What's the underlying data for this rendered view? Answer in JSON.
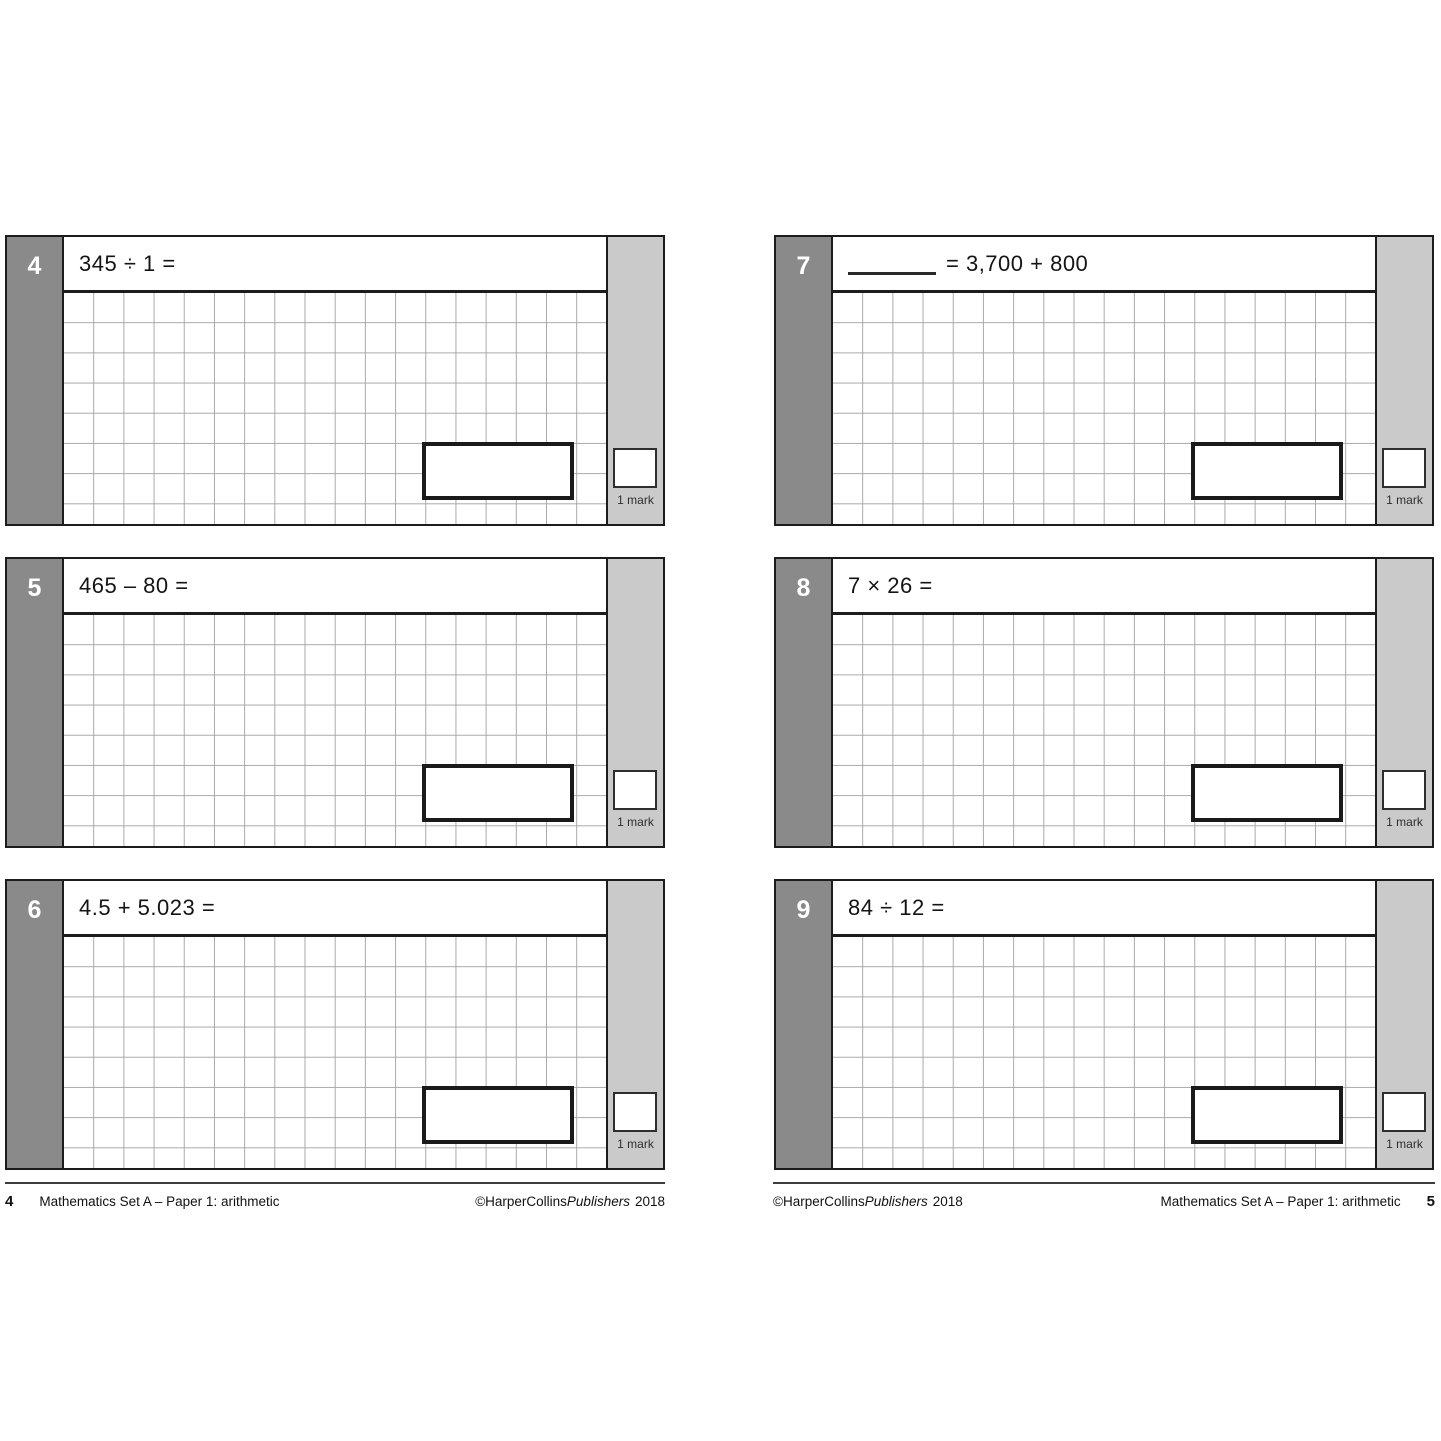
{
  "document": {
    "footer_title": "Mathematics Set A – Paper 1: arithmetic",
    "copyright_prefix": "©HarperCollins",
    "copyright_publisher": "Publishers",
    "copyright_year": "2018"
  },
  "pages": {
    "left_page_number": "4",
    "right_page_number": "5"
  },
  "questions": [
    {
      "number": "4",
      "text": "345 ÷ 1 =",
      "mark": "1 mark"
    },
    {
      "number": "5",
      "text": "465 – 80 =",
      "mark": "1 mark"
    },
    {
      "number": "6",
      "text": "4.5 + 5.023 =",
      "mark": "1 mark"
    },
    {
      "number": "7",
      "text": "= 3,700 + 800",
      "mark": "1 mark",
      "answer_blank_before_text": true
    },
    {
      "number": "8",
      "text": "7 × 26 =",
      "mark": "1 mark"
    },
    {
      "number": "9",
      "text": "84 ÷ 12 =",
      "mark": "1 mark"
    }
  ],
  "colors": {
    "badge_gray": "#8a8a8a",
    "mark_column_gray": "#cacaca",
    "grid_line_gray": "#a9a9a9",
    "block_border": "#1c1c1c"
  }
}
